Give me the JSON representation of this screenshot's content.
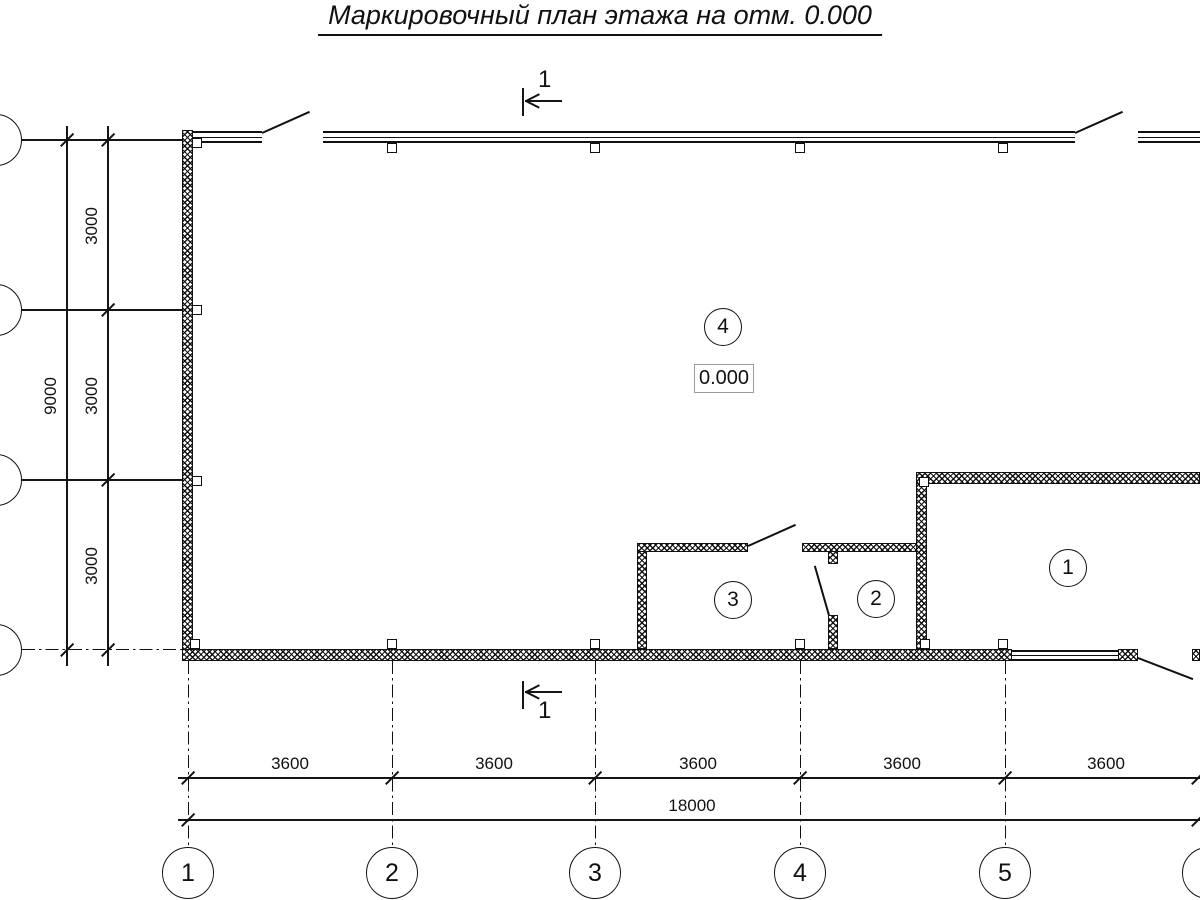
{
  "title": "Маркировочный план этажа на отм. 0.000",
  "section_mark": {
    "label": "1"
  },
  "elevation_mark": {
    "value": "0.000"
  },
  "room_labels": {
    "room1": "1",
    "room2": "2",
    "room3": "3",
    "room4": "4"
  },
  "axes": {
    "columns": {
      "labels": [
        "1",
        "2",
        "3",
        "4",
        "5",
        "6"
      ]
    },
    "dims_horizontal": {
      "bays": [
        "3600",
        "3600",
        "3600",
        "3600",
        "3600"
      ],
      "total": "18000"
    },
    "dims_vertical": {
      "bays": [
        "3000",
        "3000",
        "3000"
      ],
      "total": "9000"
    }
  }
}
